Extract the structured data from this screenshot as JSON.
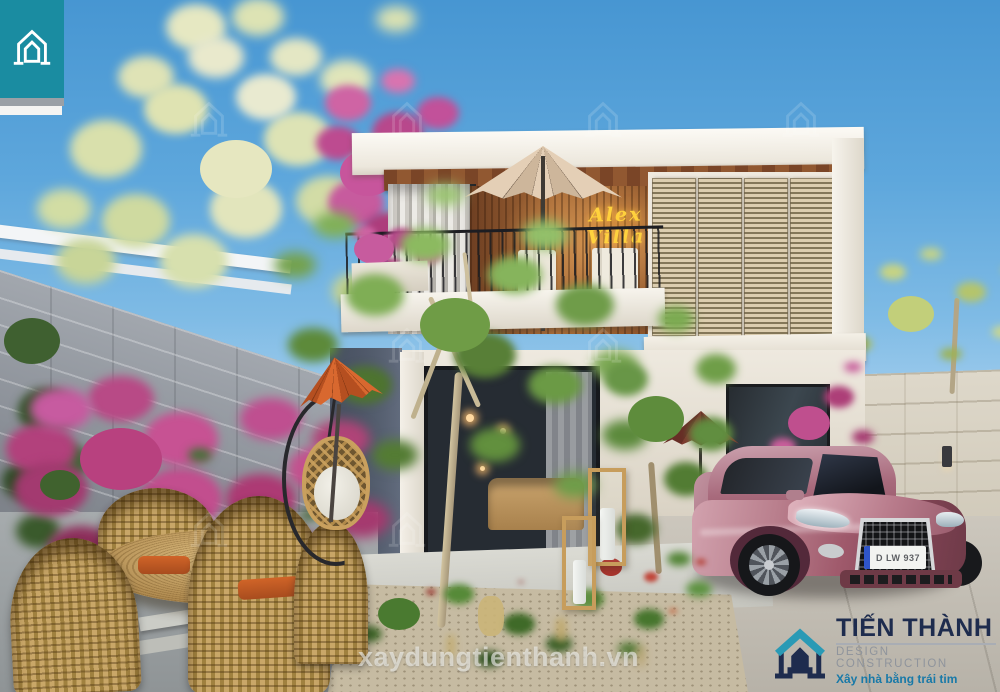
{
  "branding": {
    "corner_logo": {
      "icon": "house-icon",
      "bg_color": "#1a8ca1"
    },
    "watermark_text": "xaydungtienthanh.vn",
    "footer_logo": {
      "name": "TIẾN THÀNH",
      "subtitle": "DESIGN CONSTRUCTION",
      "tagline": "Xây nhà bằng trái tim",
      "name_color": "#1e2c4e",
      "subtitle_color": "#8f949c",
      "tagline_color": "#1879a8"
    }
  },
  "scene": {
    "building_sign": {
      "text": "Alex Villa",
      "color": "#ffd23e"
    },
    "car": {
      "type": "sedan",
      "body_color": "#b06a78",
      "license_plate": "D LW 937"
    },
    "palette": {
      "sky_top": "#4796d2",
      "sky_horizon": "#e2f1f9",
      "teal": "#1a8ca1",
      "wood_slats": "#a86b38",
      "louver": "#d0c1a4",
      "facade": "#f2efe7",
      "stone_wall_left": "#9298a0",
      "stone_wall_right": "#d6d0c2",
      "bougainvillea": "#c04a8a",
      "foliage_green": "#6f9c46",
      "umbrella_cream": "#d8c2a9",
      "umbrella_orange": "#cd5f2b",
      "rattan": "#c9a05e",
      "concrete": "#c6c1b8"
    }
  }
}
